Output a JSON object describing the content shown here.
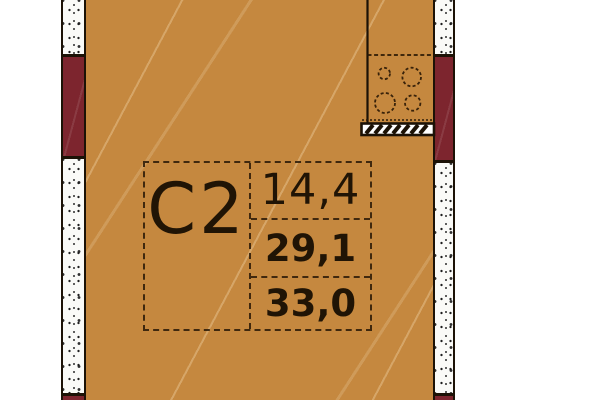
{
  "unit": {
    "label": "C2"
  },
  "areas": {
    "living": "14,4",
    "apartment": "29,1",
    "total": "33,0"
  },
  "icons": {
    "stove": "stove-burners-icon",
    "vent": "vent-hatch-icon"
  },
  "colors": {
    "background": "#ffffff",
    "floor": "#c5883f",
    "wall_red": "#7d252e",
    "wall_concrete": "#fafaf7",
    "line": "#1c1206",
    "text": "#201405"
  }
}
